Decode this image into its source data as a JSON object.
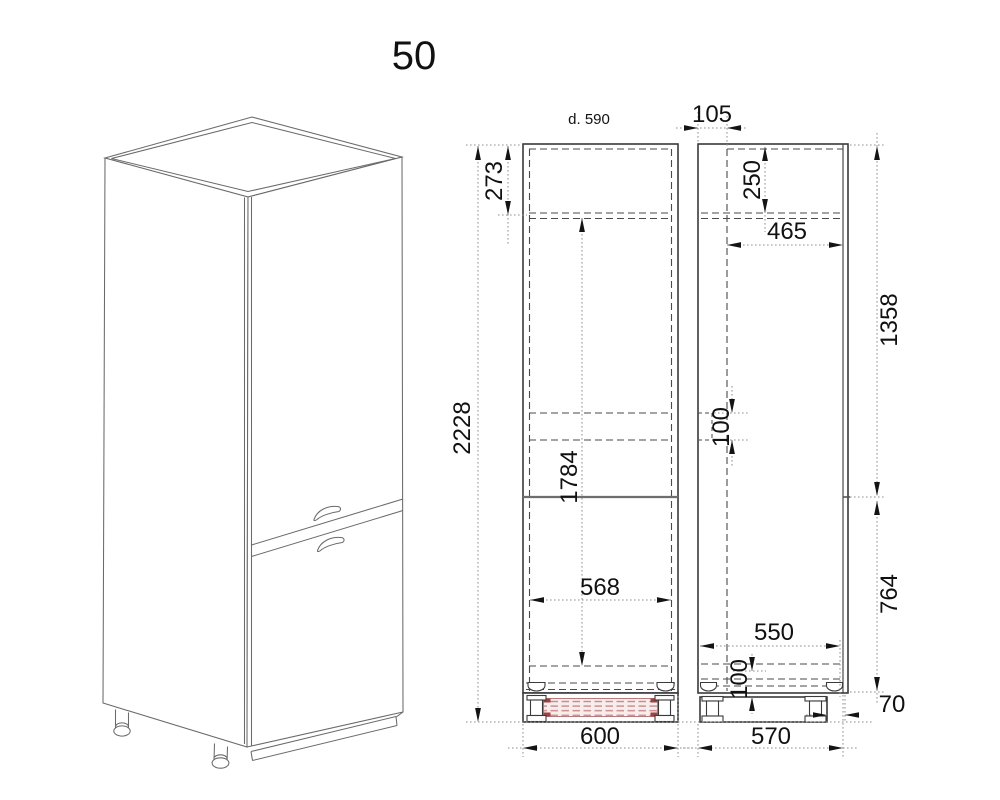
{
  "title": "50",
  "front_view": {
    "depth_label": "d. 590",
    "dim_total_height": "2228",
    "dim_top_section": "273",
    "dim_interior_height": "1784",
    "dim_interior_width": "568",
    "dim_overall_width": "600"
  },
  "side_view": {
    "dim_door_offset": "105",
    "dim_top_inset": "250",
    "dim_top_depth": "465",
    "dim_upper_height": "1358",
    "dim_shelf_slot": "100",
    "dim_lower_height": "764",
    "dim_bottom_depth": "550",
    "dim_bottom_inset": "100",
    "dim_plinth_setback": "70",
    "dim_overall_depth": "570"
  },
  "colors": {
    "line": "#3a3a3a",
    "dimension": "#141414",
    "hatch_stripe": "#c98a8a",
    "hatch_accent": "#a04040"
  }
}
